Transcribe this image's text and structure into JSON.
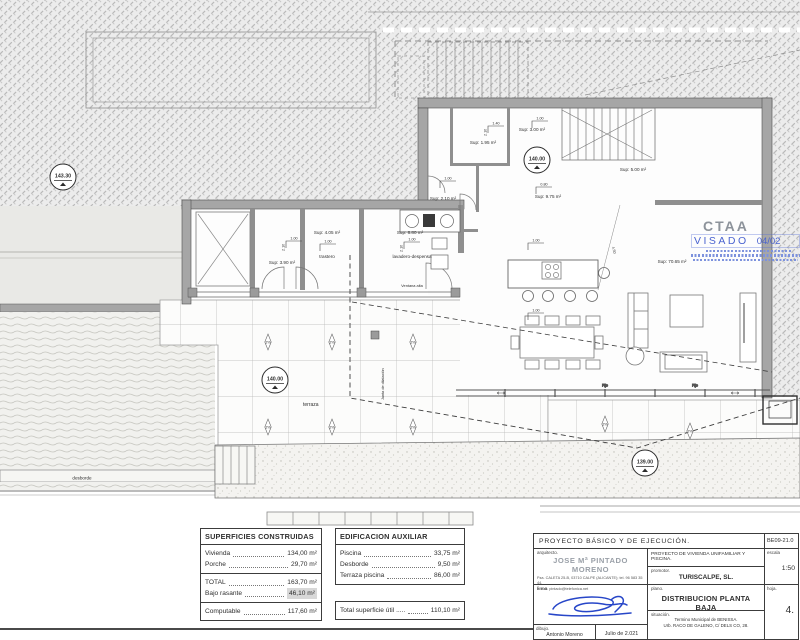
{
  "plan": {
    "levels": {
      "terrain": "143.30",
      "floor": "140.00",
      "terrace": "140.00",
      "path": "139.00"
    },
    "sups": {
      "s195": "Sup: 1.95 m²",
      "s300": "Sup: 3.00 m²",
      "s500": "Sup: 5.00 m²",
      "s975": "Sup: 9.75 m²",
      "s210": "Sup: 2.10 m²",
      "s390": "Sup: 3.90 m²",
      "s405": "Sup: 4.05 m²",
      "s880": "Sup: 8.80 m²",
      "s7065": "Sup: 70.65 m²"
    },
    "labels": {
      "trastero": "trastero",
      "lavadero": "lavadero-despensa",
      "terraza": "terraza",
      "desborde": "desborde",
      "ventana_alta": "Ventana alta",
      "junta": "Junta de dilatación",
      "fijo": "Fijo",
      "slope": "2%"
    },
    "dims": {
      "w140": "1.40",
      "w100": "1.00",
      "w080": "0.80",
      "h210": "2.10",
      "d450": "4.50"
    }
  },
  "stamp": {
    "org": "CTAA",
    "visado": "VISADO",
    "fecha": "04/02"
  },
  "tables": {
    "superficies": {
      "title": "SUPERFICIES CONSTRUIDAS",
      "rows": [
        {
          "label": "Vivienda",
          "value": "134,00 m²"
        },
        {
          "label": "Porche",
          "value": "29,70 m²"
        }
      ],
      "total": {
        "label": "TOTAL",
        "value": "163,70 m²"
      },
      "bajo": {
        "label": "Bajo rasante",
        "value": "46,10 m²"
      },
      "computable": {
        "label": "Computable",
        "value": "117,60 m²"
      }
    },
    "auxiliar": {
      "title": "EDIFICACION AUXILIAR",
      "rows": [
        {
          "label": "Piscina",
          "value": "33,75 m²"
        },
        {
          "label": "Desborde",
          "value": "9,50 m²"
        },
        {
          "label": "Terraza piscina",
          "value": "86,00 m²"
        }
      ],
      "total_util": {
        "label": "Total superficie útil .....",
        "value": "110,10 m²"
      }
    }
  },
  "titleblock": {
    "header": "PROYECTO  BÁSICO  Y  DE  EJECUCIÓN.",
    "code": "BE09-21.0",
    "arquitecto_label": "arquitecto.",
    "arquitecto_name": "JOSE Mª PINTADO MORENO",
    "arquitecto_addr1": "Pza. CALETA 25-B, 03710 CALPE (ALICANTE); tel. 96 583 35 44.",
    "arquitecto_addr2": "e.mail: pintado@telefonica.net",
    "firma_label": "firma.",
    "dibujo_label": "dibujo.",
    "dibujo_name": "Antonio Moreno",
    "fecha": "Julio de 2.021",
    "proyecto": "PROYECTO DE VIVIENDA UNIFAMILIAR Y PISCINA.",
    "promotor_label": "promotor.",
    "promotor": "TURISCALPE, SL.",
    "plano_label": "plano.",
    "plano": "DISTRIBUCION PLANTA BAJA",
    "situacion_label": "situación.",
    "situacion1": "Termino Municipal de BENISSA.",
    "situacion2": "Urb. RACO DE GALENO, C/ DELS CO, 28.",
    "escala_label": "escala",
    "escala": "1:50",
    "hoja_label": "hoja.",
    "hoja": "4."
  }
}
